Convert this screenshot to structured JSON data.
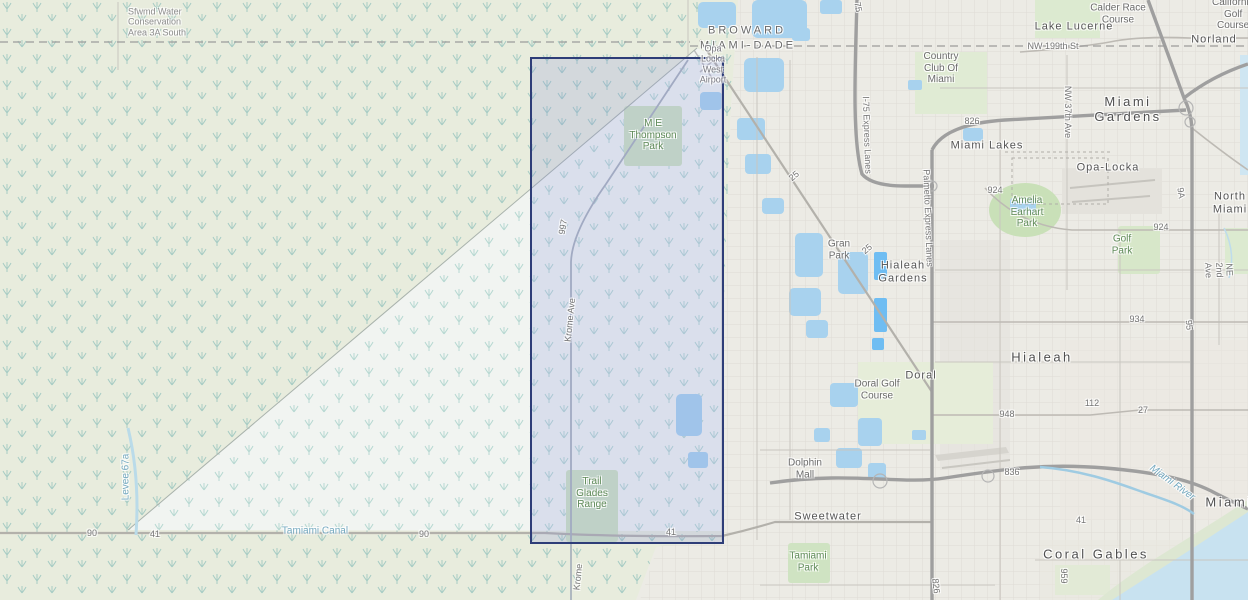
{
  "map": {
    "kind": "topographic-street-map",
    "selection": {
      "fill": "rgba(128,138,222,0.20)",
      "border": "#2e3d78",
      "x": 530,
      "y": 57,
      "w": 190,
      "h": 483
    }
  },
  "labels": [
    {
      "name": "label-water-conservation-area",
      "text": "Sfwmd Water\nConservation\nArea 3A South",
      "x": 128,
      "y": 22,
      "cls": "area",
      "anchor": "left"
    },
    {
      "name": "label-county-broward",
      "text": "BROWARD",
      "x": 747,
      "y": 31,
      "cls": "county"
    },
    {
      "name": "label-county-miami-dade",
      "text": "MIAMI-DADE",
      "x": 748,
      "y": 46,
      "cls": "county"
    },
    {
      "name": "label-opa-locka-west-airport",
      "text": "Opa\nLocka\nWest\nAirport",
      "x": 713,
      "y": 64,
      "cls": "airport"
    },
    {
      "name": "label-me-thompson-park",
      "text": "M E\nThompson\nPark",
      "x": 653,
      "y": 135,
      "cls": "park"
    },
    {
      "name": "label-trail-glades-range",
      "text": "Trail\nGlades\nRange",
      "x": 592,
      "y": 493,
      "cls": "park"
    },
    {
      "name": "label-road-997",
      "text": "997",
      "x": 563,
      "y": 227,
      "cls": "road",
      "rot": -80
    },
    {
      "name": "label-krome-ave",
      "text": "Krome Ave",
      "x": 570,
      "y": 320,
      "cls": "road",
      "rot": -84
    },
    {
      "name": "label-krome-ave-south",
      "text": "Krome",
      "x": 578,
      "y": 577,
      "cls": "road",
      "rot": -84
    },
    {
      "name": "label-levee-67a",
      "text": "Levee 67a",
      "x": 126,
      "y": 477,
      "cls": "water",
      "rot": -90
    },
    {
      "name": "label-tamiami-canal",
      "text": "Tamiami Canal",
      "x": 315,
      "y": 531,
      "cls": "water"
    },
    {
      "name": "label-route-90-west",
      "text": "90",
      "x": 92,
      "y": 533,
      "cls": "road"
    },
    {
      "name": "label-route-41-west",
      "text": "41",
      "x": 155,
      "y": 534,
      "cls": "road"
    },
    {
      "name": "label-route-90-mid",
      "text": "90",
      "x": 424,
      "y": 534,
      "cls": "road"
    },
    {
      "name": "label-route-41-mid",
      "text": "41",
      "x": 671,
      "y": 532,
      "cls": "road"
    },
    {
      "name": "label-calder-race-course",
      "text": "Calder Race\nCourse",
      "x": 1118,
      "y": 14,
      "cls": "place"
    },
    {
      "name": "label-california-golf-course",
      "text": "California\nGolf Course",
      "x": 1212,
      "y": 14,
      "cls": "place",
      "anchor": "left"
    },
    {
      "name": "label-lake-lucerne",
      "text": "Lake Lucerne",
      "x": 1074,
      "y": 27,
      "cls": "city"
    },
    {
      "name": "label-norland",
      "text": "Norland",
      "x": 1214,
      "y": 40,
      "cls": "city"
    },
    {
      "name": "label-nw-199th-st",
      "text": "NW 199th St",
      "x": 1053,
      "y": 46,
      "cls": "road"
    },
    {
      "name": "label-country-club-of-miami",
      "text": "Country\nClub Of\nMiami",
      "x": 941,
      "y": 68,
      "cls": "place"
    },
    {
      "name": "label-miami-gardens",
      "text": "Miami Gardens",
      "x": 1128,
      "y": 110,
      "cls": "city-lg"
    },
    {
      "name": "label-nw-37th-ave",
      "text": "NW 37th Ave",
      "x": 1068,
      "y": 112,
      "cls": "road",
      "rot": 90
    },
    {
      "name": "label-route-826-top",
      "text": "826",
      "x": 972,
      "y": 121,
      "cls": "road"
    },
    {
      "name": "label-route-75",
      "text": "75",
      "x": 858,
      "y": 7,
      "cls": "road",
      "rot": 78
    },
    {
      "name": "label-miami-lakes",
      "text": "Miami Lakes",
      "x": 987,
      "y": 146,
      "cls": "city"
    },
    {
      "name": "label-opa-locka",
      "text": "Opa-Locka",
      "x": 1108,
      "y": 168,
      "cls": "city"
    },
    {
      "name": "label-i75-express-lanes",
      "text": "I-75 Express Lanes",
      "x": 867,
      "y": 135,
      "cls": "road",
      "rot": 88
    },
    {
      "name": "label-palmetto-express-lanes",
      "text": "Palmetto Express Lanes",
      "x": 928,
      "y": 218,
      "cls": "road",
      "rot": 88
    },
    {
      "name": "label-route-25-north",
      "text": "25",
      "x": 794,
      "y": 176,
      "cls": "road",
      "rot": -40
    },
    {
      "name": "label-route-25-south",
      "text": "25",
      "x": 867,
      "y": 249,
      "cls": "road",
      "rot": -40
    },
    {
      "name": "label-route-9a",
      "text": "9A",
      "x": 1181,
      "y": 193,
      "cls": "road",
      "rot": 82
    },
    {
      "name": "label-north-miami",
      "text": "North Miami",
      "x": 1212,
      "y": 203,
      "cls": "city",
      "anchor": "left"
    },
    {
      "name": "label-route-924-west",
      "text": "924",
      "x": 995,
      "y": 190,
      "cls": "road"
    },
    {
      "name": "label-route-924-east",
      "text": "924",
      "x": 1161,
      "y": 227,
      "cls": "road"
    },
    {
      "name": "label-amelia-earhart-park",
      "text": "Amelia\nEarhart\nPark",
      "x": 1027,
      "y": 212,
      "cls": "park"
    },
    {
      "name": "label-golf-park",
      "text": "Golf\nPark",
      "x": 1122,
      "y": 245,
      "cls": "park"
    },
    {
      "name": "label-gran-park",
      "text": "Gran\nPark",
      "x": 839,
      "y": 250,
      "cls": "place"
    },
    {
      "name": "label-hialeah-gardens",
      "text": "Hialeah\nGardens",
      "x": 903,
      "y": 272,
      "cls": "city"
    },
    {
      "name": "label-ne-2nd-ave",
      "text": "NE 2nd Ave",
      "x": 1219,
      "y": 270,
      "cls": "road",
      "rot": 88
    },
    {
      "name": "label-route-934",
      "text": "934",
      "x": 1137,
      "y": 319,
      "cls": "road"
    },
    {
      "name": "label-route-95",
      "text": "95",
      "x": 1189,
      "y": 325,
      "cls": "road",
      "rot": 84
    },
    {
      "name": "label-hialeah",
      "text": "Hialeah",
      "x": 1042,
      "y": 358,
      "cls": "city-lg"
    },
    {
      "name": "label-doral",
      "text": "Doral",
      "x": 921,
      "y": 376,
      "cls": "city"
    },
    {
      "name": "label-doral-golf-course",
      "text": "Doral Golf\nCourse",
      "x": 877,
      "y": 390,
      "cls": "place"
    },
    {
      "name": "label-route-112",
      "text": "112",
      "x": 1092,
      "y": 403,
      "cls": "road"
    },
    {
      "name": "label-route-27",
      "text": "27",
      "x": 1143,
      "y": 410,
      "cls": "road"
    },
    {
      "name": "label-route-948",
      "text": "948",
      "x": 1007,
      "y": 414,
      "cls": "road"
    },
    {
      "name": "label-dolphin-mall",
      "text": "Dolphin\nMall",
      "x": 805,
      "y": 469,
      "cls": "place"
    },
    {
      "name": "label-route-836",
      "text": "836",
      "x": 1012,
      "y": 472,
      "cls": "road"
    },
    {
      "name": "label-miami-river",
      "text": "Miami River",
      "x": 1172,
      "y": 483,
      "cls": "water-it",
      "rot": 36
    },
    {
      "name": "label-miami",
      "text": "Miami",
      "x": 1229,
      "y": 503,
      "cls": "city-lg"
    },
    {
      "name": "label-sweetwater",
      "text": "Sweetwater",
      "x": 828,
      "y": 517,
      "cls": "city"
    },
    {
      "name": "label-route-41-east",
      "text": "41",
      "x": 1081,
      "y": 520,
      "cls": "road"
    },
    {
      "name": "label-tamiami-park",
      "text": "Tamiami\nPark",
      "x": 808,
      "y": 562,
      "cls": "park"
    },
    {
      "name": "label-route-826-south",
      "text": "826",
      "x": 936,
      "y": 586,
      "cls": "road",
      "rot": 84
    },
    {
      "name": "label-route-959",
      "text": "959",
      "x": 1064,
      "y": 576,
      "cls": "road",
      "rot": 90
    },
    {
      "name": "label-coral-gables",
      "text": "Coral Gables",
      "x": 1096,
      "y": 555,
      "cls": "city-lg"
    }
  ]
}
